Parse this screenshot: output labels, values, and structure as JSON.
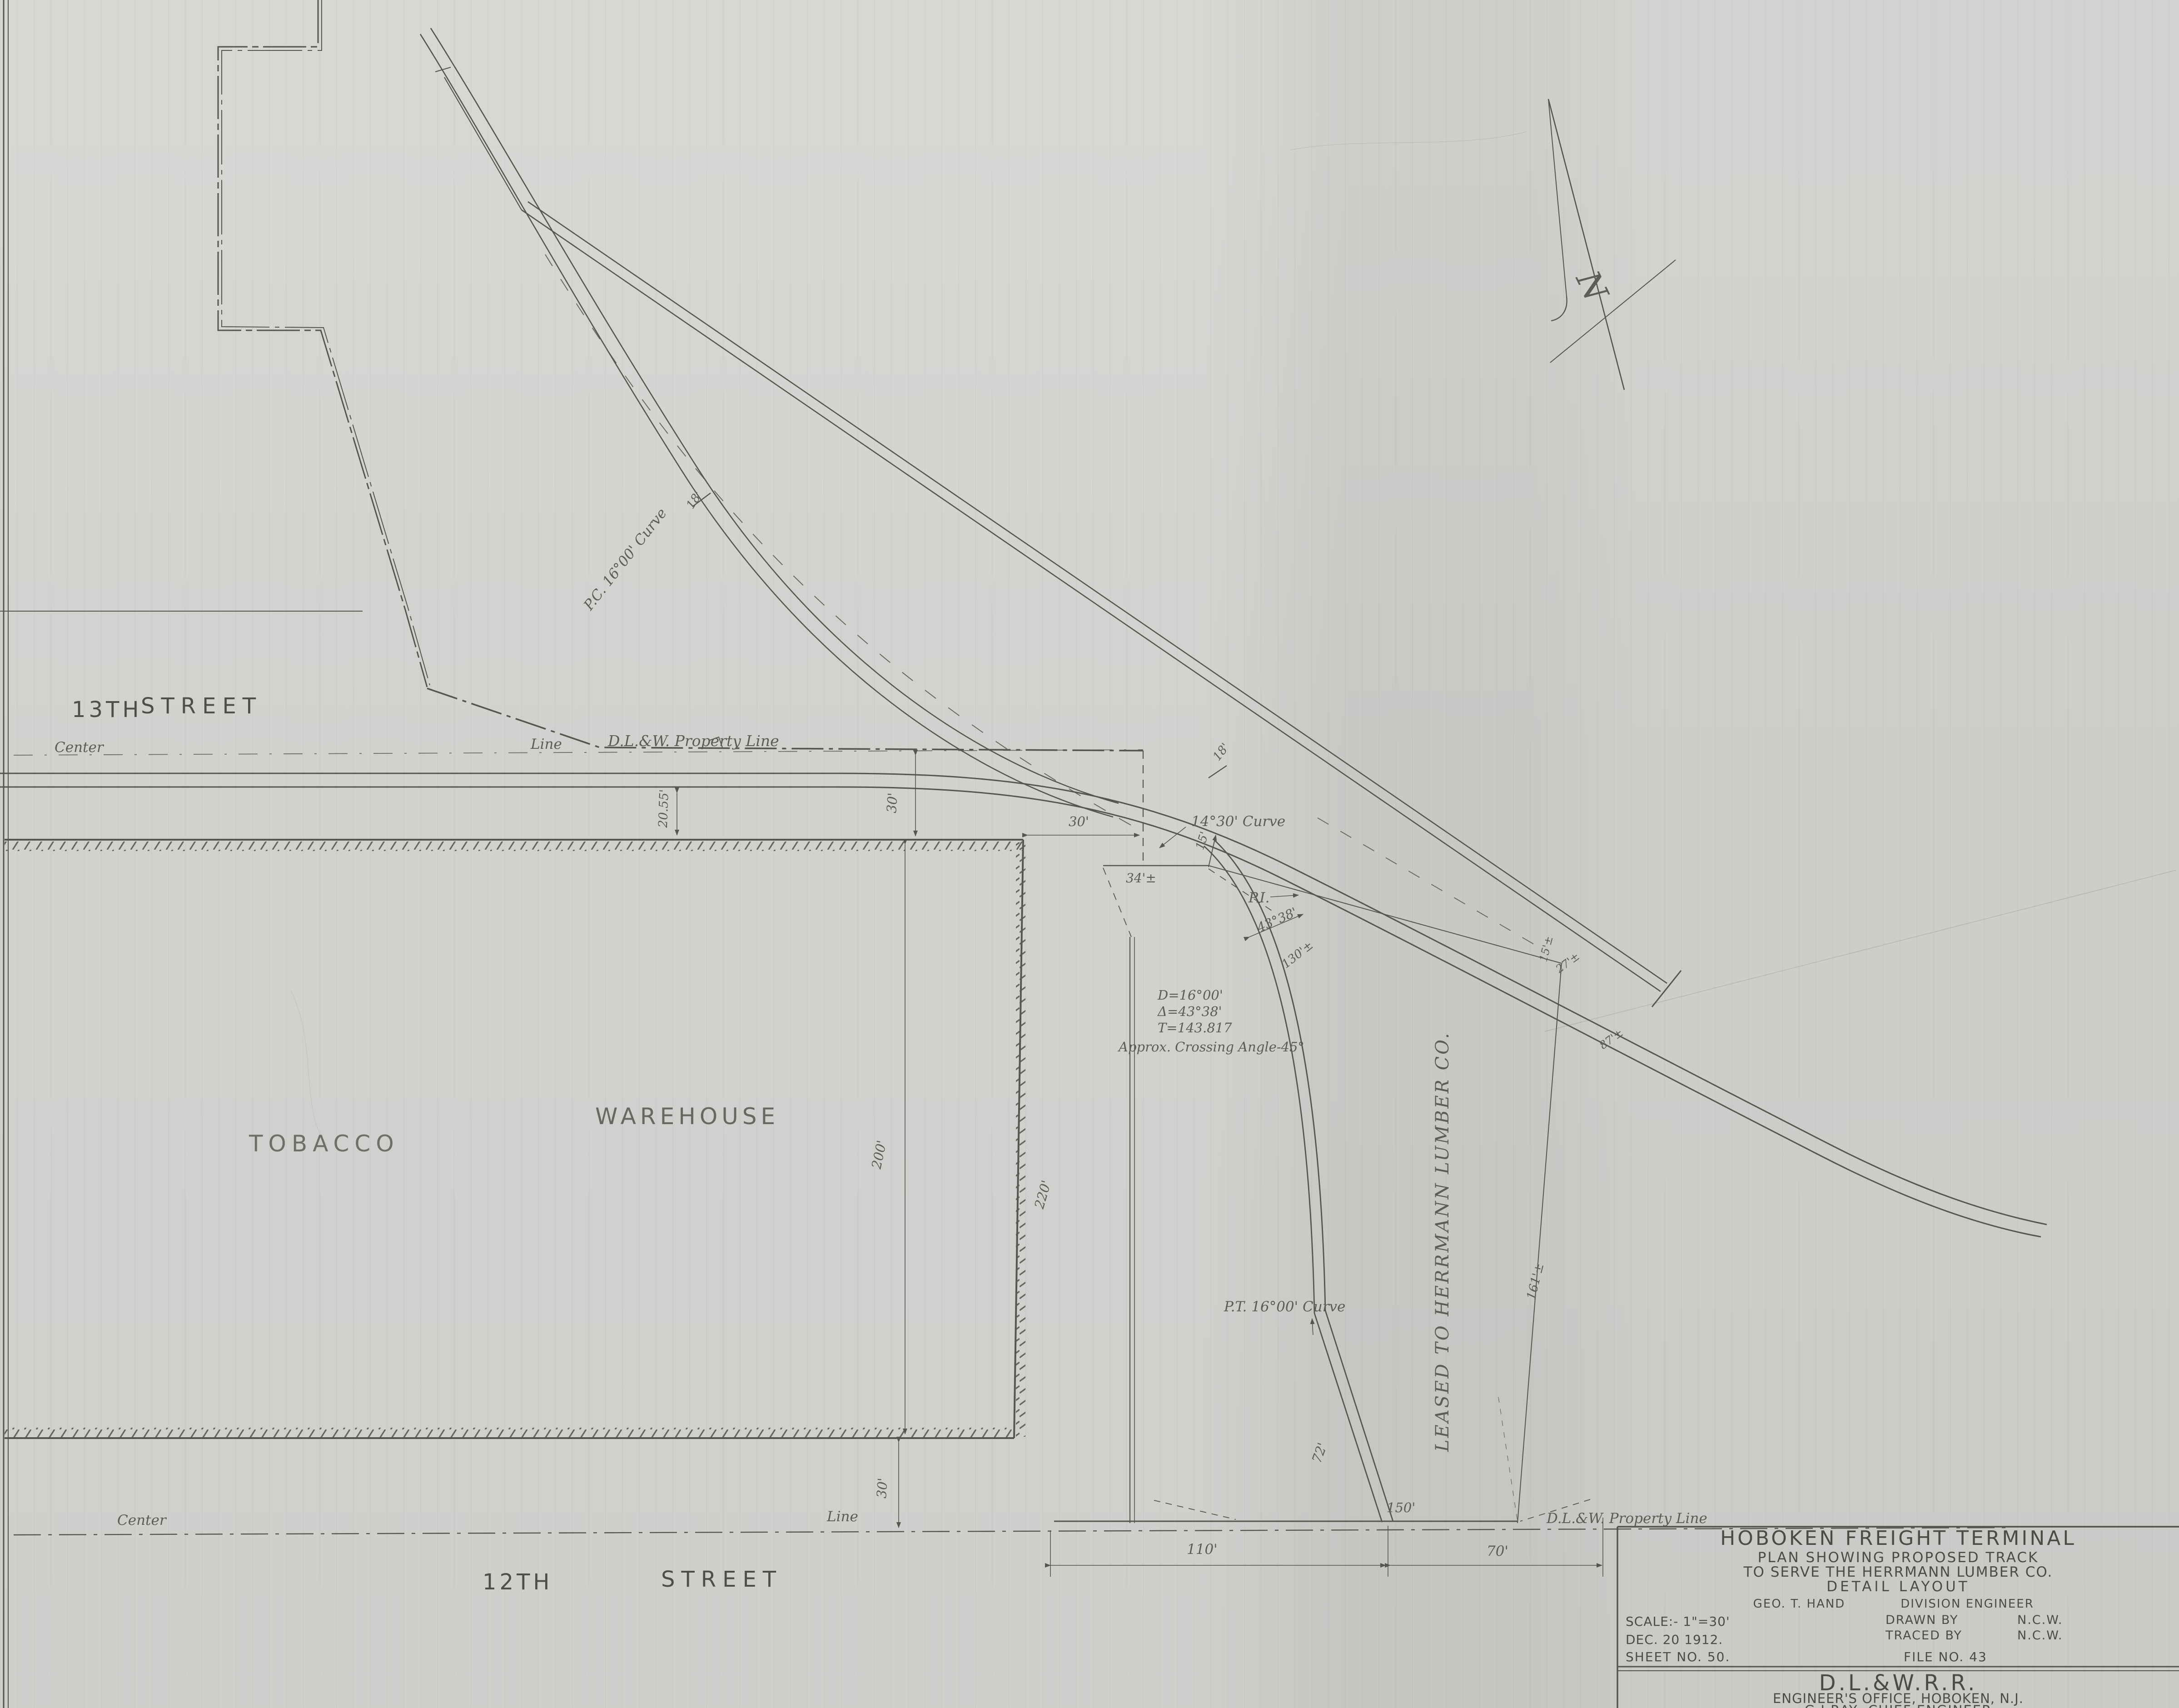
{
  "drawing": {
    "streets": {
      "thirteenth": {
        "number": "13TH",
        "name": "STREET",
        "center": "Center",
        "line": "Line"
      },
      "twelfth": {
        "number": "12TH",
        "name": "STREET",
        "center": "Center",
        "line": "Line"
      }
    },
    "buildings": {
      "tobacco": "TOBACCO",
      "warehouse": "WAREHOUSE"
    },
    "lease_note": "LEASED TO HERRMANN LUMBER CO.",
    "property_line_label_top": "D.L.&W. Property Line",
    "property_line_label_bottom": "D.L.&W. Property Line",
    "north_label": "N",
    "curve_notes": {
      "pc": "P.C. 16°00' Curve",
      "c1430": "14°30' Curve",
      "pi": "P.I.",
      "delta_along": "43°38'",
      "eq_d": "D=16°00'",
      "eq_delta": "Δ=43°38'",
      "eq_t": "T=143.817",
      "crossing": "Approx. Crossing Angle-45°",
      "pt": "P.T. 16°00' Curve"
    },
    "dimensions": {
      "d20_55": "20.55'",
      "d30_prop": "30'",
      "d30_corner": "30'",
      "d30_bottom": "30'",
      "d34": "34'±",
      "d15": "15'",
      "d18_a": "18'",
      "d18_b": "18'",
      "d15b": "15'±",
      "d27": "27'±",
      "d87": "87'±",
      "d130": "130'±",
      "d161": "161'±",
      "d200": "200'",
      "d220": "220'",
      "d72": "72'",
      "d150": "150'",
      "d110": "110'",
      "d70": "70'"
    }
  },
  "title_block": {
    "l1": "HOBOKEN FREIGHT TERMINAL",
    "l2": "PLAN SHOWING PROPOSED TRACK",
    "l3": "TO SERVE THE HERRMANN LUMBER CO.",
    "l4": "DETAIL LAYOUT",
    "engineer_name": "GEO. T. HAND",
    "engineer_title": "DIVISION ENGINEER",
    "scale": "SCALE:- 1\"=30'",
    "drawn_by_label": "DRAWN BY",
    "drawn_by": "N.C.W.",
    "traced_by_label": "TRACED BY",
    "traced_by": "N.C.W.",
    "date": "DEC. 20 1912.",
    "sheet_no": "SHEET NO. 50.",
    "file_no": "FILE NO. 43",
    "railroad": "D.L.&W.R.R.",
    "office": "ENGINEER'S OFFICE, HOBOKEN, N.J.",
    "chief": "G.J.RAY  CHIEF ENGINEER"
  }
}
